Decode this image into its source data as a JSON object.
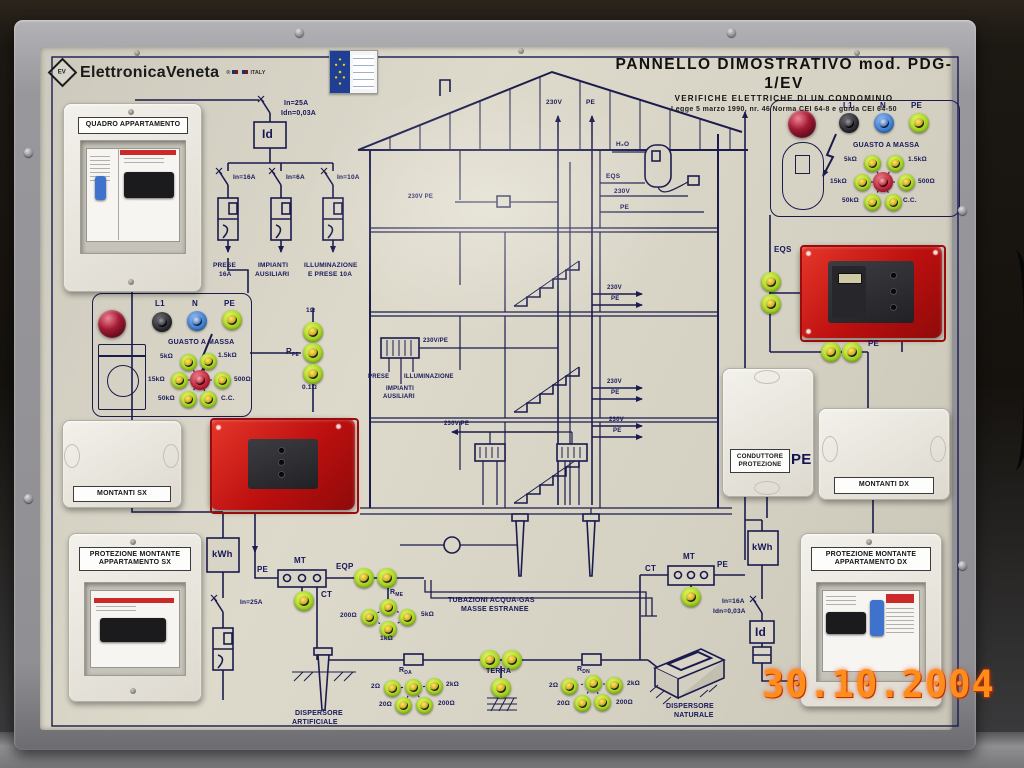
{
  "window": {
    "date_stamp": "30.10.2004"
  },
  "header": {
    "brand_mark": "EV",
    "brand": "ElettronicaVeneta",
    "brand_suffix": "ITALY",
    "title": "PANNELLO DIMOSTRATIVO mod. PDG-1/EV",
    "subtitle": "VERIFICHE ELETTRICHE DI UN CONDOMINIO",
    "law_line": "Legge 5 marzo 1990, nr. 46   Norma CEI 64-8 e guida CEI 64-50"
  },
  "enclosures": {
    "quadro_label": "QUADRO APPARTAMENTO",
    "montanti_sx": "MONTANTI SX",
    "montanti_dx": "MONTANTI DX",
    "conduttore_line1": "CONDUTTORE",
    "conduttore_line2": "PROTEZIONE",
    "conduttore_pe": "PE",
    "protezione_sx_line1": "PROTEZIONE MONTANTE",
    "protezione_sx_line2": "APPARTAMENTO SX",
    "protezione_dx_line1": "PROTEZIONE MONTANTE",
    "protezione_dx_line2": "APPARTAMENTO DX"
  },
  "apartment_panel": {
    "main_breaker": "In=25A",
    "main_breaker_idn": "Idn=0,03A",
    "differential": "Id",
    "branch_breakers": [
      "In=16A",
      "In=6A",
      "In=10A"
    ],
    "branch_circuits": [
      [
        "PRESE",
        "16A"
      ],
      [
        "IMPIANTI",
        "AUSILIARI"
      ],
      [
        "ILLUMINAZIONE",
        "E PRESE 10A"
      ]
    ]
  },
  "fault_box": {
    "terminals": [
      "L1",
      "N",
      "PE"
    ],
    "title": "GUASTO A MASSA",
    "resistors": [
      "5kΩ",
      "1.5kΩ",
      "15kΩ",
      "500Ω",
      "50kΩ",
      "C.C."
    ]
  },
  "rpe": {
    "name": "R",
    "sub": "PE",
    "values": [
      "1Ω",
      "0.1Ω"
    ]
  },
  "house": {
    "volt": "230V",
    "pe": "PE",
    "volt_pe": "230V/PE",
    "volt_pe_dot": "230V PE",
    "h2o": "H₂O",
    "eqs": "EQS",
    "prese": "PRESE",
    "illuminazione": "ILLUMINAZIONE",
    "impianti_line1": "IMPIANTI",
    "impianti_line2": "AUSILIARI"
  },
  "service_left": {
    "kwh": "kWh",
    "breaker": "In=25A",
    "pe": "PE",
    "mt": "MT",
    "ct": "CT",
    "eqp": "EQP",
    "rme_name": "R",
    "rme_sub": "ME",
    "rme_values": [
      "200Ω",
      "5kΩ",
      "1kΩ"
    ],
    "pipe_line1": "TUBAZIONI ACQUA-GAS",
    "pipe_line2": "MASSE ESTRANEE"
  },
  "service_right": {
    "kwh": "kWh",
    "ct": "CT",
    "mt": "MT",
    "pe": "PE",
    "breaker": "In=16A",
    "breaker_idn": "Idn=0,03A",
    "differential": "Id",
    "eqs": "EQS",
    "pe_jacks": "PE"
  },
  "earth": {
    "rda_name": "R",
    "rda_sub": "DA",
    "rdn_name": "R",
    "rdn_sub": "DN",
    "values": [
      "2Ω",
      "2kΩ",
      "20Ω",
      "200Ω"
    ],
    "terra": "TERRA",
    "artificial_line1": "DISPERSORE",
    "artificial_line2": "ARTIFICIALE",
    "natural_line1": "DISPERSORE",
    "natural_line2": "NATURALE"
  },
  "colors": {
    "panel": "#d8d4c6",
    "line": "#1b1b4e",
    "jack_green": "#a9d528",
    "socket_red": "#bc0f0f",
    "lamp_red": "#a21a33",
    "date_orange": "#ff8d1a"
  }
}
